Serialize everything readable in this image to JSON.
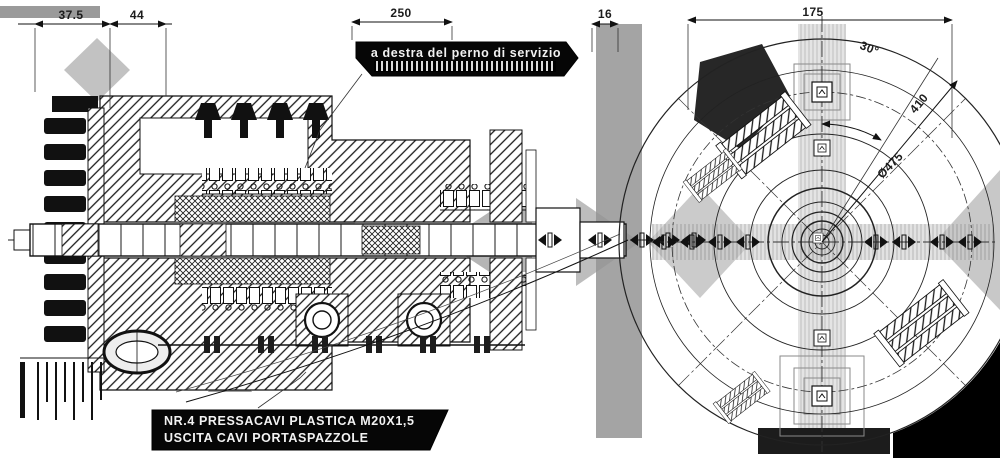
{
  "colors": {
    "background": "#ffffff",
    "ink": "#111111",
    "note_background": "#060606",
    "note_text": "#f2f2f2",
    "artifact_gray": "#9a9a9a"
  },
  "side_view": {
    "dim_left_a": "37.5",
    "dim_left_b": "44",
    "dim_top": "250",
    "dim_right": "16",
    "service_pin_note": "a destra del perno di servizio",
    "cable_gland_note_line1": "NR.4 PRESSACAVI PLASTICA M20X1,5",
    "cable_gland_note_line2": "USCITA CAVI PORTASPAZZOLE"
  },
  "end_view": {
    "dim_width": "175",
    "dim_angle": "30°",
    "dim_diameter_outer": "410",
    "dim_diameter_bolt_circle": "Ø475"
  }
}
